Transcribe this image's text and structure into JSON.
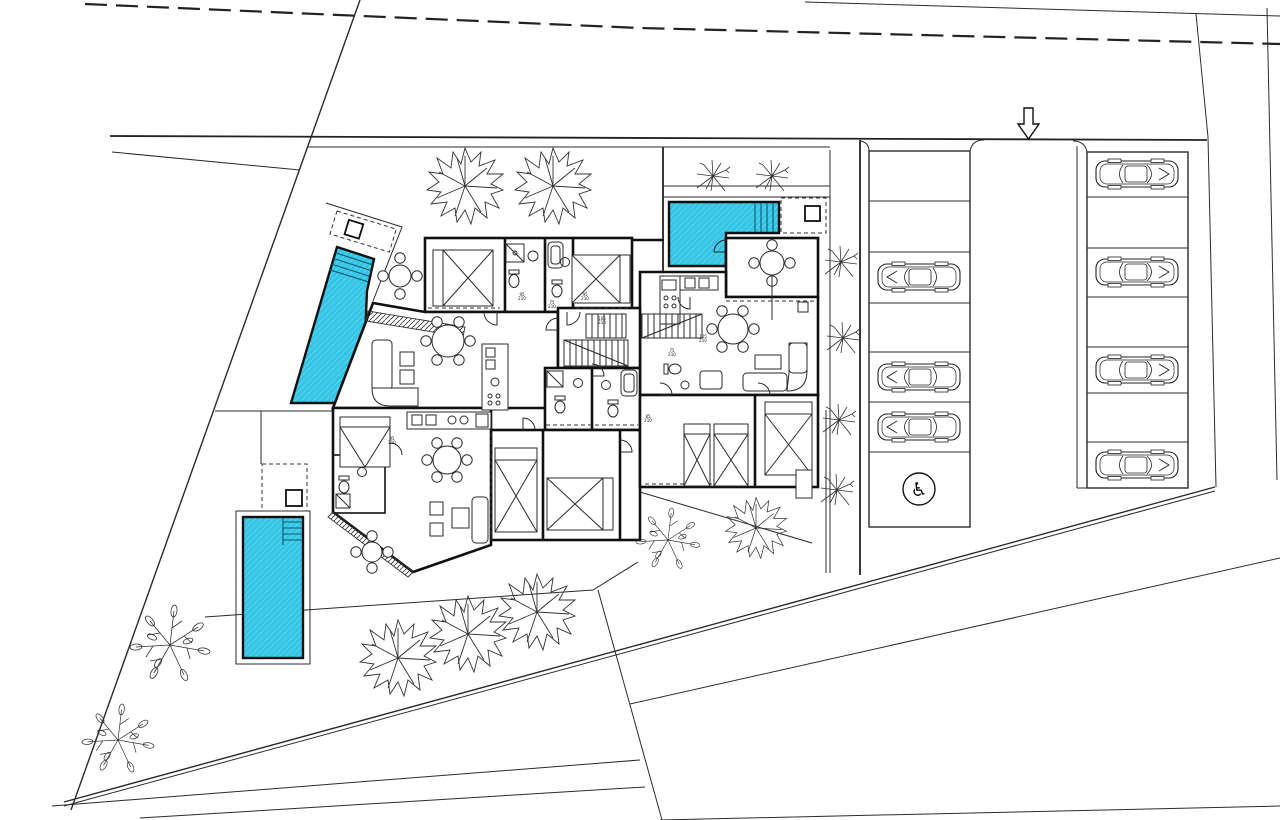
{
  "plan": {
    "kind": "architectural-site-plan",
    "pools_count": 3,
    "entrance_arrow_direction": "down",
    "door_tags": [
      [
        "95",
        "210"
      ],
      [
        "75",
        "210"
      ],
      [
        "95",
        "210"
      ],
      [
        "105",
        "210"
      ],
      [
        "75",
        "210"
      ],
      [
        "105",
        "210"
      ],
      [
        "85",
        "210"
      ],
      [
        "95",
        "210"
      ]
    ]
  },
  "colors": {
    "pool": "#33C4E6",
    "pool_hatch": "#5ED2EC",
    "line": "#2b2b2b",
    "wall": "#101010",
    "paper": "#ffffff"
  },
  "parking": {
    "accessible_icon": "♿",
    "left_column": {
      "bays": 7,
      "cars": 3,
      "accessible_bays": 1,
      "occupancy": [
        "empty",
        "empty",
        "car",
        "empty",
        "car",
        "car",
        "accessible"
      ]
    },
    "right_column": {
      "bays": 7,
      "cars": 4,
      "occupancy": [
        "car",
        "empty",
        "car",
        "empty",
        "car",
        "empty",
        "car"
      ]
    }
  },
  "landscape": {
    "large_trees": 6,
    "leafy_trees": 3,
    "shrubs": 6
  }
}
